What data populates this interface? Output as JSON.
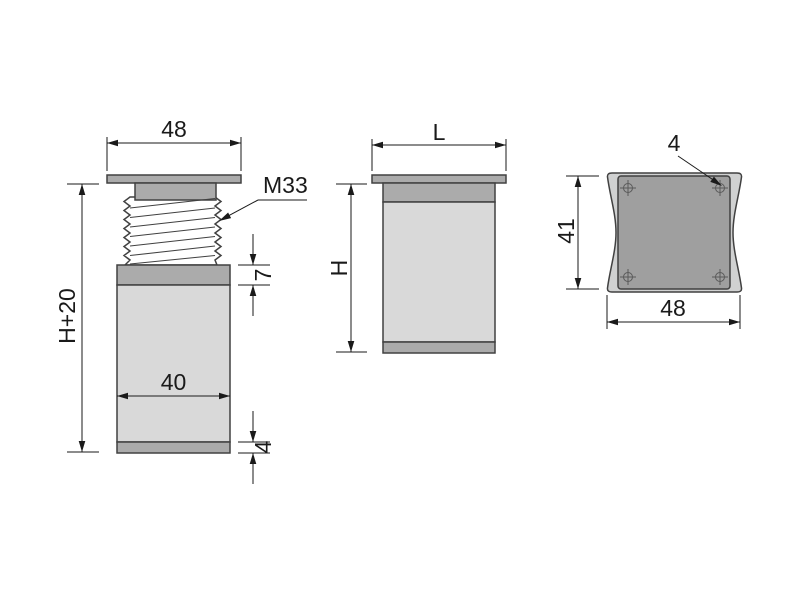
{
  "views": {
    "side": {
      "top_width": "48",
      "thread": "M33",
      "overall_height": "H+20",
      "collar_height": "7",
      "body_width": "40",
      "foot_height": "4"
    },
    "front": {
      "width": "L",
      "height": "H"
    },
    "top": {
      "hole": "4",
      "depth": "41",
      "width": "48"
    }
  },
  "colors": {
    "background": "#ffffff",
    "body_light": "#d9d9d9",
    "metal_medium": "#ababab",
    "plate_top": "#d0d1d1",
    "square_top": "#9f9f9f",
    "thread_fill": "#ffffff",
    "outline": "#414141",
    "dimension": "#1a1a1a"
  }
}
